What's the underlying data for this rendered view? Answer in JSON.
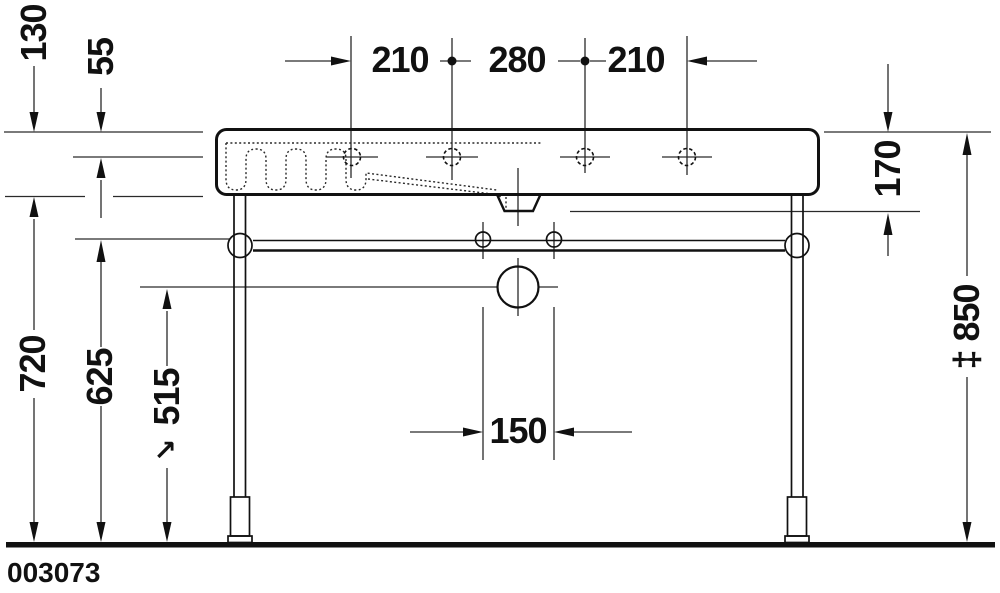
{
  "drawing": {
    "type": "washbasin-with-metal-console-dimension-drawing",
    "product_code": "003073"
  },
  "labels": {
    "d130": "130",
    "d55": "55",
    "d210_left": "210",
    "d280": "280",
    "d210_right": "210",
    "d170": "170",
    "d850": "‡ 850",
    "d720": "720",
    "d625": "625",
    "d515": "515",
    "d515_arrow": "↗",
    "d150": "150",
    "product_code": "003073"
  },
  "colors": {
    "line": "#2a2a2a",
    "outline": "#111111",
    "text": "#111111",
    "background": "#ffffff"
  }
}
